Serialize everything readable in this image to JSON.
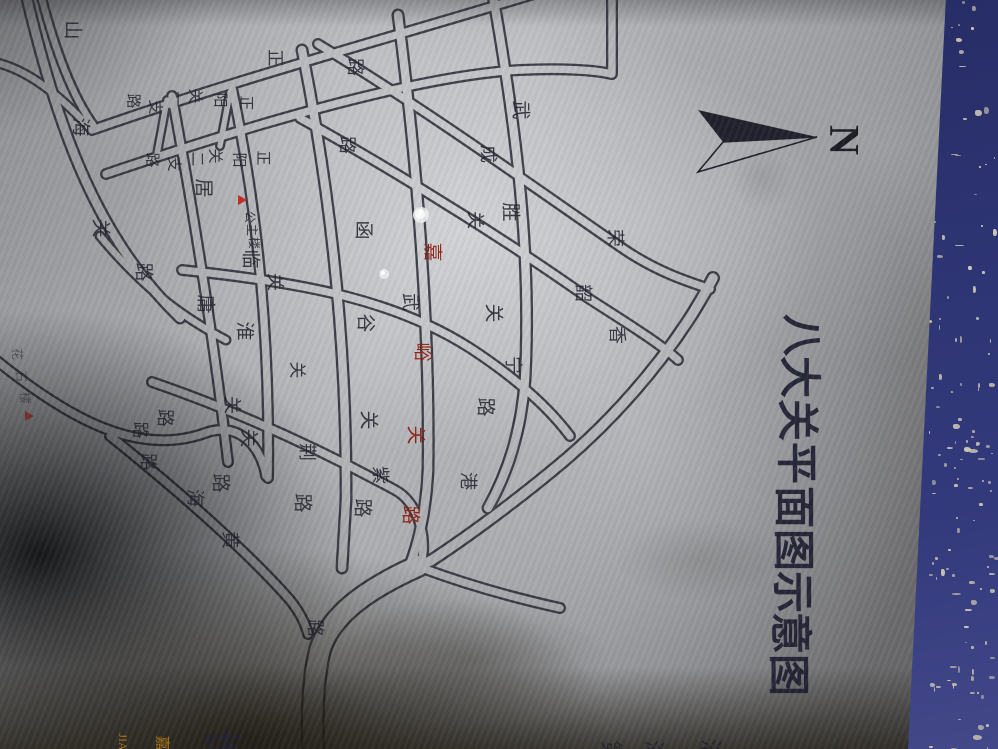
{
  "sign": {
    "kind": "engraved metal street-map sign, photographed rotated 90 degrees",
    "title": {
      "text": "八大关平面图示意图",
      "chars": [
        [
          "八",
          800,
          335
        ],
        [
          "大",
          798,
          377
        ],
        [
          "关",
          796,
          420
        ],
        [
          "平",
          795,
          463
        ],
        [
          "面",
          793,
          507
        ],
        [
          "图",
          792,
          550
        ],
        [
          "示",
          791,
          592
        ],
        [
          "意",
          789,
          633
        ],
        [
          "图",
          787,
          675
        ]
      ],
      "size": 42
    },
    "north_arrow": {
      "label": "N",
      "label_x": 843,
      "label_y": 140,
      "label_size": 42,
      "filled_polygon": "698,110 817,137 723,142",
      "outline_polygon": "723,142 817,137 698,172"
    },
    "colors": {
      "ink": "#22232e",
      "red_road": "#8f1e12",
      "marker_red": "#c32718",
      "orange": "#b07818",
      "frame_blue": "#2e3574",
      "frame_speckle": "#cfc8b4"
    },
    "roads": [
      {
        "name": "山海关路",
        "size": 19,
        "chars": [
          [
            "山",
            72,
            30
          ],
          [
            "海",
            80,
            127
          ],
          [
            "关",
            100,
            228
          ],
          [
            "路",
            143,
            272
          ]
        ]
      },
      {
        "name": "正阳关一支路",
        "size": 15,
        "chars": [
          [
            "正",
            245,
            103
          ],
          [
            "阳",
            219,
            100
          ],
          [
            "关",
            194,
            96
          ],
          [
            "一",
            176,
            99
          ],
          [
            "支",
            154,
            107
          ],
          [
            "路",
            132,
            101
          ]
        ]
      },
      {
        "name": "正阳关二支路",
        "size": 15,
        "chars": [
          [
            "正",
            262,
            158
          ],
          [
            "阳",
            238,
            160
          ],
          [
            "关",
            214,
            156
          ],
          [
            "二",
            196,
            159
          ],
          [
            "支",
            173,
            164
          ],
          [
            "路",
            151,
            160
          ]
        ]
      },
      {
        "name": "居庸关路",
        "size": 19,
        "chars": [
          [
            "居",
            203,
            188
          ],
          [
            "庸",
            205,
            304
          ],
          [
            "路",
            220,
            483
          ]
        ]
      },
      {
        "name": "临淮关路",
        "size": 19,
        "chars": [
          [
            "临",
            250,
            259
          ],
          [
            "淮",
            244,
            331
          ],
          [
            "关",
            248,
            438
          ],
          [
            "路",
            302,
            503
          ]
        ]
      },
      {
        "name": "函谷关路",
        "size": 19,
        "chars": [
          [
            "函",
            363,
            230
          ],
          [
            "谷",
            365,
            323
          ],
          [
            "关",
            368,
            420
          ],
          [
            "路",
            362,
            508
          ]
        ]
      },
      {
        "name": "嘉峪关路",
        "size": 19,
        "red": true,
        "chars": [
          [
            "嘉",
            432,
            252
          ],
          [
            "峪",
            422,
            352
          ],
          [
            "关",
            415,
            435
          ],
          [
            "路",
            410,
            515
          ]
        ]
      },
      {
        "name": "武胜关路",
        "size": 19,
        "chars": [
          [
            "武",
            520,
            110
          ],
          [
            "胜",
            510,
            212
          ],
          [
            "关",
            493,
            313
          ],
          [
            "路",
            485,
            407
          ]
        ]
      },
      {
        "name": "宁武关路",
        "size": 18,
        "chars": [
          [
            "宁",
            513,
            365
          ],
          [
            "武",
            410,
            302
          ],
          [
            "关",
            275,
            282
          ]
        ]
      },
      {
        "name": "韶关路",
        "size": 18,
        "chars": [
          [
            "韶",
            583,
            293
          ],
          [
            "关",
            475,
            220
          ],
          [
            "路",
            347,
            145
          ]
        ]
      },
      {
        "name": "荣成路",
        "size": 18,
        "chars": [
          [
            "荣",
            615,
            238
          ],
          [
            "成",
            488,
            154
          ],
          [
            "路",
            355,
            67
          ]
        ]
      },
      {
        "name": "紫荆关路",
        "size": 18,
        "chars": [
          [
            "紫",
            380,
            475
          ],
          [
            "荆",
            307,
            452
          ],
          [
            "关",
            232,
            405
          ],
          [
            "路",
            165,
            418
          ]
        ]
      },
      {
        "name": "黄海路",
        "size": 18,
        "chars": [
          [
            "黄",
            230,
            540
          ],
          [
            "海",
            195,
            498
          ],
          [
            "路",
            148,
            462
          ]
        ]
      },
      {
        "name": "香港西路",
        "size": 18,
        "chars": [
          [
            "香",
            617,
            335
          ],
          [
            "港",
            468,
            481
          ],
          [
            "路",
            315,
            628
          ]
        ]
      },
      {
        "name": "正阳关路",
        "size": 17,
        "chars": [
          [
            "正",
            275,
            58
          ]
        ]
      },
      {
        "name": "misc",
        "size": 17,
        "chars": [
          [
            "关",
            297,
            370
          ],
          [
            "路",
            140,
            430
          ]
        ]
      }
    ],
    "landmarks": [
      {
        "name": "公主楼",
        "size": 12,
        "marker": {
          "x": 242,
          "y": 200
        },
        "chars": [
          [
            "公",
            250,
            217
          ],
          [
            "主",
            252,
            230
          ],
          [
            "楼",
            254,
            243
          ]
        ]
      },
      {
        "name": "花石楼",
        "size": 12,
        "dim": true,
        "marker": {
          "x": 29,
          "y": 416
        },
        "chars": [
          [
            "花",
            17,
            354
          ],
          [
            "石",
            21,
            376
          ],
          [
            "楼",
            25,
            398
          ]
        ]
      }
    ],
    "bottom_edge": {
      "big_char": {
        "ch": "长",
        "x": 222,
        "y": 746,
        "size": 40
      },
      "orange_pinyin": {
        "text": "JIA",
        "x": 123,
        "y": 742,
        "size": 12
      },
      "orange_char": {
        "ch": "嘉",
        "x": 161,
        "y": 743,
        "size": 15
      },
      "partial_chars": {
        "size": 22,
        "chars": [
          [
            "第",
            610,
            751
          ],
          [
            "海",
            653,
            751
          ],
          [
            "浴",
            710,
            750
          ]
        ]
      }
    },
    "holes": [
      {
        "x": 421,
        "y": 215,
        "r": 8
      },
      {
        "x": 384,
        "y": 274,
        "r": 5
      }
    ],
    "geometry": {
      "road_paths": [
        {
          "d": "M 25,-10 C 60,140 100,240 180,318",
          "w": 13
        },
        {
          "d": "M 172,96 C 195,220 215,350 228,462",
          "w": 12
        },
        {
          "d": "M 232,88 C 258,210 270,340 268,478",
          "w": 12
        },
        {
          "d": "M 302,50 C 330,190 347,340 346,500 L 342,568",
          "w": 13
        },
        {
          "d": "M 398,15 C 418,170 430,330 428,470 C 426,512 418,545 408,570",
          "w": 13
        },
        {
          "d": "M 492,-10 C 515,120 532,250 525,380 C 521,432 508,472 488,508",
          "w": 13
        },
        {
          "d": "M 92,130 C 240,78 400,35 534,-6",
          "w": 12
        },
        {
          "d": "M 106,174 C 300,108 440,74 520,70 C 560,68 596,70 611,74",
          "w": 12
        },
        {
          "d": "M 612,-8 L 612,74",
          "w": 12
        },
        {
          "d": "M 300,118 C 420,185 520,250 588,298 C 625,322 658,342 678,360",
          "w": 12
        },
        {
          "d": "M 318,44 C 430,112 545,195 625,250 C 658,272 686,281 710,289",
          "w": 12
        },
        {
          "d": "M 182,270 C 310,283 398,302 470,348 C 522,382 552,412 570,436",
          "w": 12
        },
        {
          "d": "M 152,382 C 245,414 325,452 395,490 C 418,502 428,538 421,563",
          "w": 12
        },
        {
          "d": "M 110,436 C 190,500 255,560 290,600 C 298,610 305,622 308,634",
          "w": 12
        },
        {
          "d": "M 713,278 C 682,338 628,406 565,460 C 520,498 470,535 432,560 L 420,566",
          "w": 14
        },
        {
          "d": "M 418,566 C 360,592 330,618 320,650 C 313,678 312,712 313,749",
          "w": 24
        },
        {
          "d": "M 422,568 C 465,584 515,598 560,608",
          "w": 12
        },
        {
          "d": "M -6,62 C 30,70 62,98 90,128",
          "w": 11
        },
        {
          "d": "M 40,-8 C 55,50 72,96 94,126",
          "w": 11
        },
        {
          "d": "M 167,100 L 157,154",
          "w": 10
        },
        {
          "d": "M 230,92 L 220,146",
          "w": 10
        },
        {
          "d": "M -4,360 C 70,420 140,458 208,432 C 242,422 262,450 266,476",
          "w": 12
        },
        {
          "d": "M 100,236 C 150,296 192,322 226,340",
          "w": 11
        }
      ],
      "frame_left_top_x": 947,
      "frame_left_bottom_x": 908
    }
  }
}
